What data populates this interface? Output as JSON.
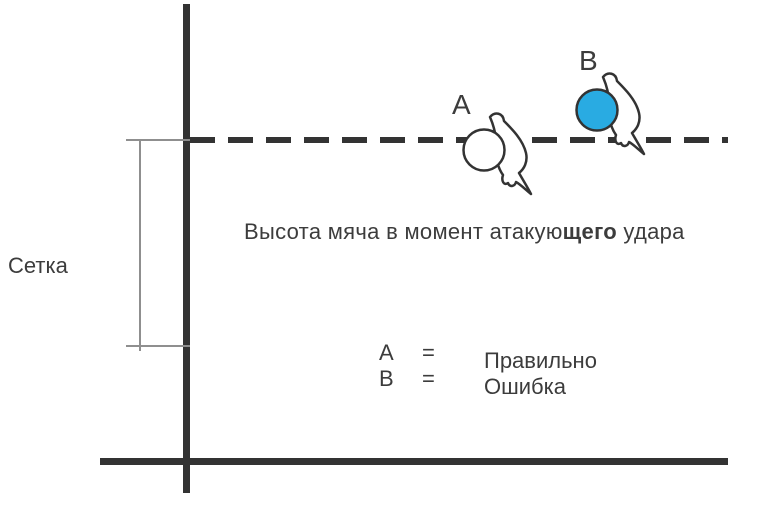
{
  "diagram": {
    "net_label": "Сетка",
    "caption": {
      "part1": "Высота мяча в момент атакую",
      "bold_part": "щего",
      "part2": " удара"
    },
    "ball_a": {
      "label": "A",
      "fill": "#ffffff",
      "meaning": "Правильно"
    },
    "ball_b": {
      "label": "B",
      "fill": "#29ABE2",
      "meaning": "Ошибка"
    },
    "legend": {
      "rows": [
        {
          "key": "A",
          "eq": "=",
          "value": "Правильно"
        },
        {
          "key": "B",
          "eq": "=",
          "value": "Ошибка"
        }
      ]
    },
    "colors": {
      "line": "#333333",
      "bracket": "#8f8f8f",
      "text": "#3c3c3c",
      "ball_b_fill": "#29ABE2"
    }
  }
}
